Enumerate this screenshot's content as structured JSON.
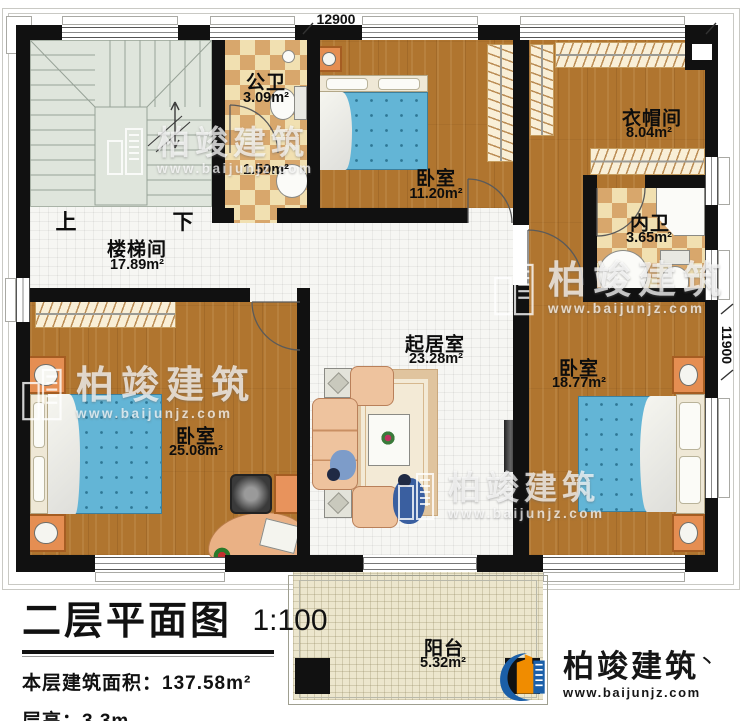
{
  "dimensions": {
    "width": "12900",
    "height": "11900"
  },
  "stairs": {
    "up": "上",
    "down": "下"
  },
  "rooms": [
    {
      "name": "楼梯间",
      "area": "17.89m²"
    },
    {
      "name": "公卫",
      "area": "3.09m²"
    },
    {
      "name": "",
      "area": "1.50m²"
    },
    {
      "name": "卧室",
      "area": "11.20m²"
    },
    {
      "name": "衣帽间",
      "area": "8.04m²"
    },
    {
      "name": "内卫",
      "area": "3.65m²"
    },
    {
      "name": "起居室",
      "area": "23.28m²"
    },
    {
      "name": "卧室",
      "area": "18.77m²"
    },
    {
      "name": "卧室",
      "area": "25.08m²"
    },
    {
      "name": "阳台",
      "area": "5.32m²"
    }
  ],
  "title_block": {
    "title": "二层平面图",
    "scale": "1:100",
    "area_label": "本层建筑面积：",
    "area_value": "137.58m²",
    "height_label": "层高：",
    "height_value": "3.3m"
  },
  "brand": {
    "name": "柏竣建筑",
    "url": "www.baijunjz.com",
    "tick": "丶"
  },
  "colors": {
    "wall": "#111111",
    "wood": "#b0752f",
    "tile_tan": "#d8a76c",
    "tile_cream": "#f1e0b1",
    "bed_blue": "#63b5d6",
    "stair": "#dfe5dc",
    "balcony": "#ece6cd",
    "logo_blue": "#1b5fa8",
    "logo_orange": "#f08c00"
  }
}
